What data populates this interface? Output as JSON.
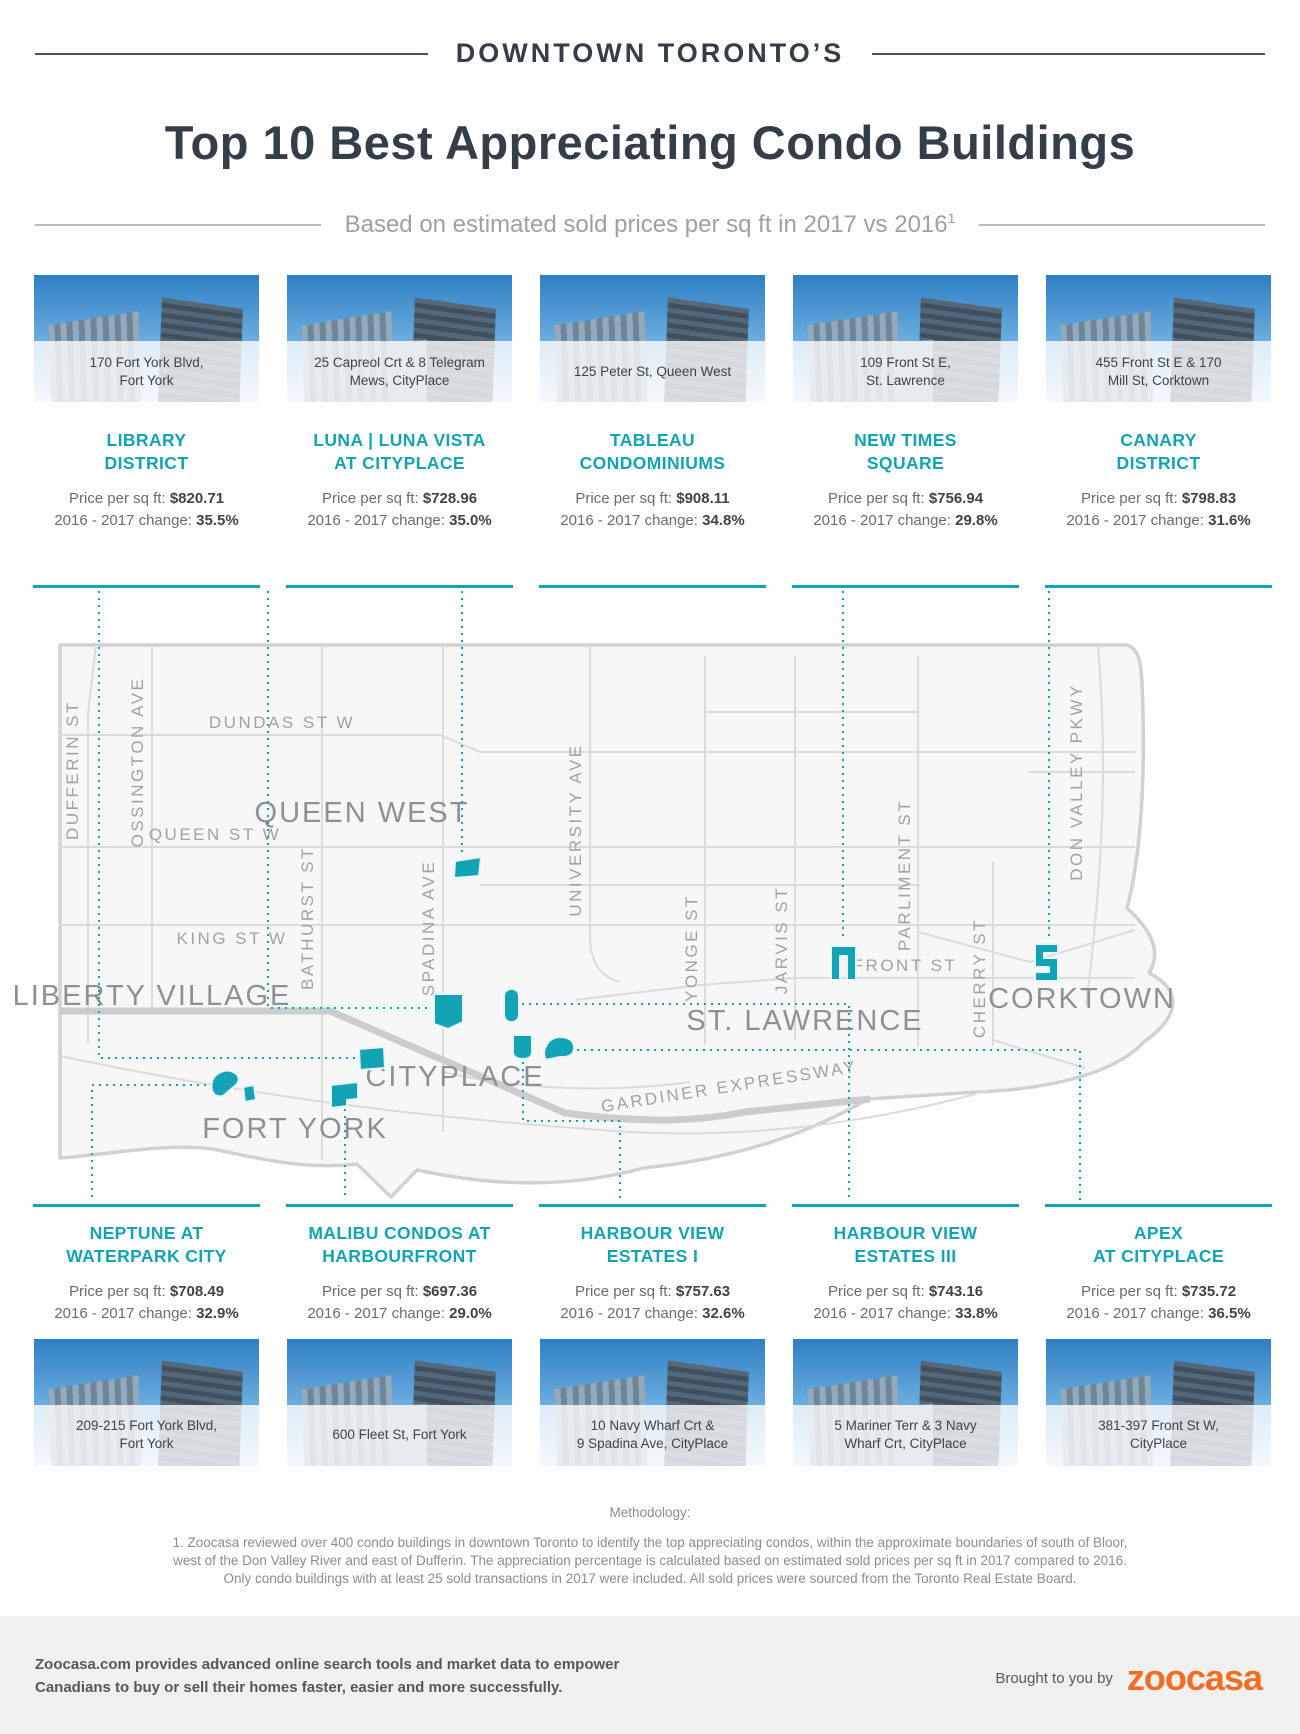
{
  "header": {
    "kicker": "DOWNTOWN TORONTO’S",
    "title": "Top 10 Best Appreciating Condo Buildings",
    "subtitle": "Based on estimated sold prices per sq ft in 2017 vs 2016",
    "footnote_mark": "1"
  },
  "labels": {
    "price": "Price per sq ft:",
    "change": "2016 - 2017 change:"
  },
  "top_cards": [
    {
      "address": "170 Fort York Blvd,\nFort York",
      "name": "LIBRARY\nDISTRICT",
      "price": "$820.71",
      "change": "35.5%"
    },
    {
      "address": "25 Capreol Crt & 8 Telegram\nMews, CityPlace",
      "name": "LUNA | LUNA VISTA\nAT CITYPLACE",
      "price": "$728.96",
      "change": "35.0%"
    },
    {
      "address": "125 Peter St, Queen West",
      "name": "TABLEAU\nCONDOMINIUMS",
      "price": "$908.11",
      "change": "34.8%"
    },
    {
      "address": "109 Front St E,\nSt. Lawrence",
      "name": "NEW TIMES\nSQUARE",
      "price": "$756.94",
      "change": "29.8%"
    },
    {
      "address": "455 Front St E & 170\nMill St, Corktown",
      "name": "CANARY\nDISTRICT",
      "price": "$798.83",
      "change": "31.6%"
    }
  ],
  "bottom_cards": [
    {
      "name": "NEPTUNE AT\nWATERPARK CITY",
      "price": "$708.49",
      "change": "32.9%",
      "address": "209-215 Fort York Blvd,\nFort York"
    },
    {
      "name": "MALIBU CONDOS AT\nHARBOURFRONT",
      "price": "$697.36",
      "change": "29.0%",
      "address": "600 Fleet St, Fort York"
    },
    {
      "name": "HARBOUR VIEW\nESTATES I",
      "price": "$757.63",
      "change": "32.6%",
      "address": "10 Navy Wharf Crt &\n9 Spadina Ave, CityPlace"
    },
    {
      "name": "HARBOUR VIEW\nESTATES III",
      "price": "$743.16",
      "change": "33.8%",
      "address": "5 Mariner Terr & 3 Navy\nWharf Crt, CityPlace"
    },
    {
      "name": "APEX\nAT CITYPLACE",
      "price": "$735.72",
      "change": "36.5%",
      "address": "381-397 Front St W,\nCityPlace"
    }
  ],
  "map": {
    "streets": {
      "dufferin": "DUFFERIN ST",
      "ossington": "OSSINGTON AVE",
      "bathurst": "BATHURST ST",
      "spadina": "SPADINA AVE",
      "university": "UNIVERSITY AVE",
      "yonge": "YONGE ST",
      "jarvis": "JARVIS ST",
      "parliment": "PARLIMENT ST",
      "cherry": "CHERRY ST",
      "dvp": "DON VALLEY PKWY",
      "dundas": "DUNDAS ST W",
      "queen": "QUEEN ST W",
      "king": "KING ST W",
      "front": "FRONT ST",
      "gardiner": "GARDINER EXPRESSWAY"
    },
    "neighbourhoods": {
      "queen_west": "QUEEN WEST",
      "liberty_village": "LIBERTY VILLAGE",
      "cityplace": "CITYPLACE",
      "fort_york": "FORT YORK",
      "st_lawrence": "ST. LAWRENCE",
      "corktown": "CORKTOWN"
    }
  },
  "methodology": {
    "heading": "Methodology:",
    "body": "1. Zoocasa reviewed over 400 condo buildings in downtown Toronto to identify the top appreciating condos, within the approximate boundaries of south of Bloor,\nwest of the Don Valley River and east of Dufferin. The appreciation percentage is calculated based on estimated sold prices per sq ft in 2017 compared to 2016.\nOnly condo buildings with at least 25 sold transactions in 2017 were included. All sold prices were sourced from the Toronto Real Estate Board."
  },
  "footer": {
    "blurb": "Zoocasa.com provides advanced online search tools and market data to empower\nCanadians to buy or sell their homes faster, easier and more successfully.",
    "brought_by": "Brought to you by",
    "logo_text": "zoocasa"
  },
  "colors": {
    "teal": "#12a4b5",
    "orange": "#f26d21",
    "dark_navy": "#333e48"
  }
}
